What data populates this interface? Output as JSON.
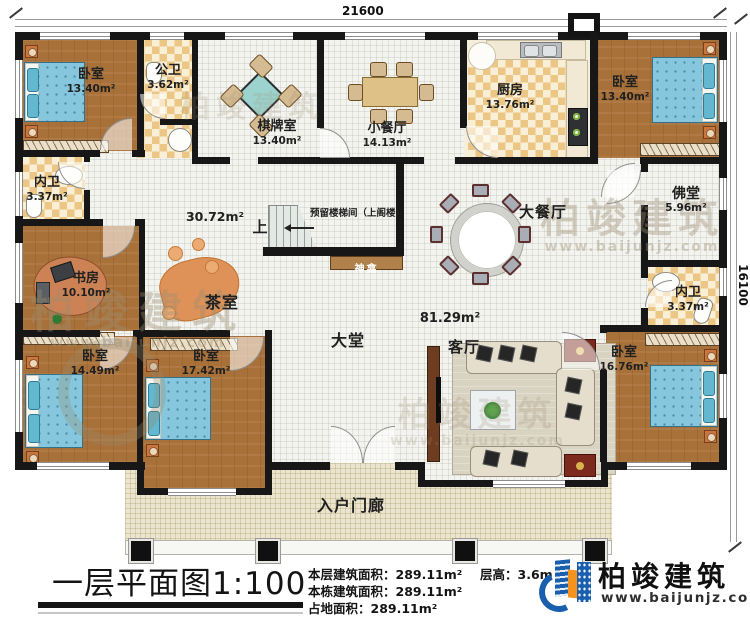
{
  "plan": {
    "dim_top": "21600",
    "dim_right": "16100",
    "stair_up": "上",
    "stair_note": "预留楼梯间（上阁楼）",
    "shrine": "神龛",
    "hall_mid_area": "30.72m²",
    "hall_main_area": "81.29m²"
  },
  "rooms": {
    "bedroom_tl": {
      "name": "卧室",
      "area": "13.40m²"
    },
    "public_bath": {
      "name": "公卫",
      "area": "3.62m²"
    },
    "chess_room": {
      "name": "棋牌室",
      "area": "13.40m²"
    },
    "small_dining": {
      "name": "小餐厅",
      "area": "14.13m²"
    },
    "kitchen": {
      "name": "厨房",
      "area": "13.76m²"
    },
    "bedroom_tr": {
      "name": "卧室",
      "area": "13.40m²"
    },
    "ensuite_left": {
      "name": "内卫",
      "area": "3.37m²"
    },
    "study": {
      "name": "书房",
      "area": "10.10m²"
    },
    "tea_room": {
      "name": "茶室"
    },
    "buddha_hall": {
      "name": "佛堂",
      "area": "5.96m²"
    },
    "ensuite_right": {
      "name": "内卫",
      "area": "3.37m²"
    },
    "bedroom_bl": {
      "name": "卧室",
      "area": "14.49m²"
    },
    "bedroom_bm": {
      "name": "卧室",
      "area": "17.42m²"
    },
    "bedroom_br": {
      "name": "卧室",
      "area": "16.76m²"
    },
    "great_hall": {
      "name": "大堂"
    },
    "living_room": {
      "name": "客厅"
    },
    "dining_hall": {
      "name": "大餐厅"
    },
    "porch": {
      "name": "入户门廊"
    }
  },
  "footer": {
    "title": "一层平面图1:100",
    "floor_area_label": "本层建筑面积：",
    "floor_area": "289.11m²",
    "building_area_label": "本栋建筑面积：",
    "building_area": "289.11m²",
    "land_area_label": "占地面积：",
    "land_area": "289.11m²",
    "story_height_label": "层高：",
    "story_height": "3.6m"
  },
  "brand": {
    "name": "柏竣建筑",
    "website": "www.baijunjz.com"
  },
  "watermark": {
    "name": "柏竣建筑",
    "website": "www.baijunjz.com"
  },
  "colors": {
    "wall": "#171717",
    "wood_floor": "#a9713a",
    "tile_dark": "#ecc684",
    "tile_light": "#f8efd6",
    "floor_light": "#f3f3ef",
    "porch": "#ebe5cf",
    "bed_blue": "#86c7dd",
    "shrine_bar": "#b0814a",
    "brand_blue": "#1a5fae",
    "brand_orange": "#f6921e"
  }
}
